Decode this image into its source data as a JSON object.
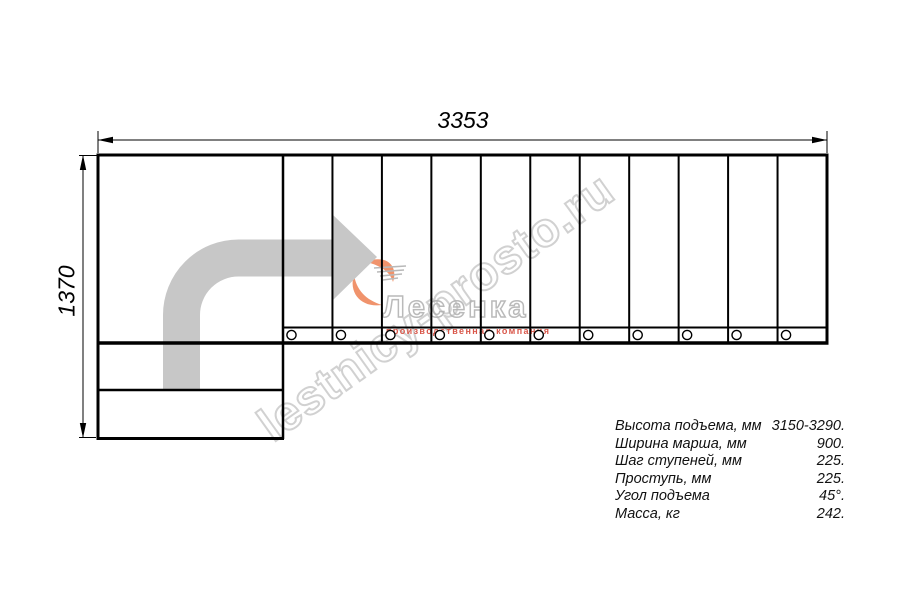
{
  "drawing": {
    "top_dimension": "3353",
    "left_dimension": "1370",
    "treads": 11
  },
  "watermark": {
    "text": "lestnicy-prosto.ru"
  },
  "logo": {
    "name": "Лесенка",
    "tagline": "производственная компания"
  },
  "specs": {
    "rows": [
      {
        "label": "Высота подъема, мм",
        "value": "3150-3290."
      },
      {
        "label": "Ширина марша, мм",
        "value": "900."
      },
      {
        "label": "Шаг ступеней, мм",
        "value": "225."
      },
      {
        "label": "Проступь, мм",
        "value": "225."
      },
      {
        "label": "Угол подъема",
        "value": "45°."
      },
      {
        "label": "Масса, кг",
        "value": "242."
      }
    ]
  },
  "colors": {
    "line": "#000000",
    "direction_arrow": "#c7c7c7",
    "watermark_gray": "#c6c6c6",
    "logo_gray": "#b3b3b3",
    "logo_orange": "#f0936c",
    "logo_red": "#d9574a"
  }
}
